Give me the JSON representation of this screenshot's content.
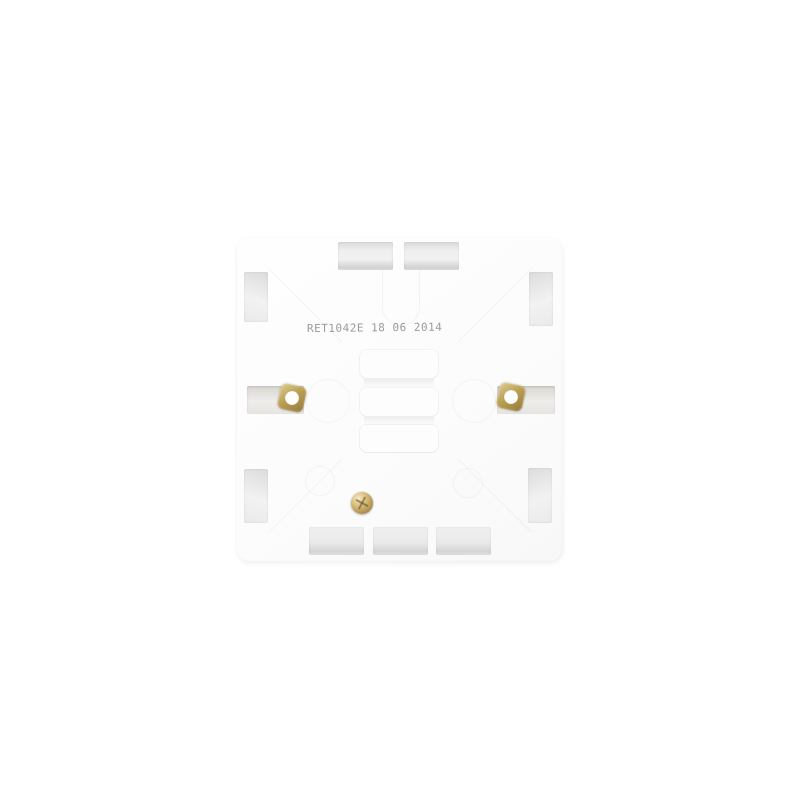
{
  "stamp": {
    "text": "RET1042E 18 06 2014",
    "color": "#9a9a9a"
  },
  "colors": {
    "background": "#ffffff",
    "box_body": "#fcfcfc",
    "recess_shadow": "#d8d8d8",
    "recess_light": "#f2f2f2",
    "brass_nut": "#bca052",
    "brass_screw": "#d9c07c"
  }
}
